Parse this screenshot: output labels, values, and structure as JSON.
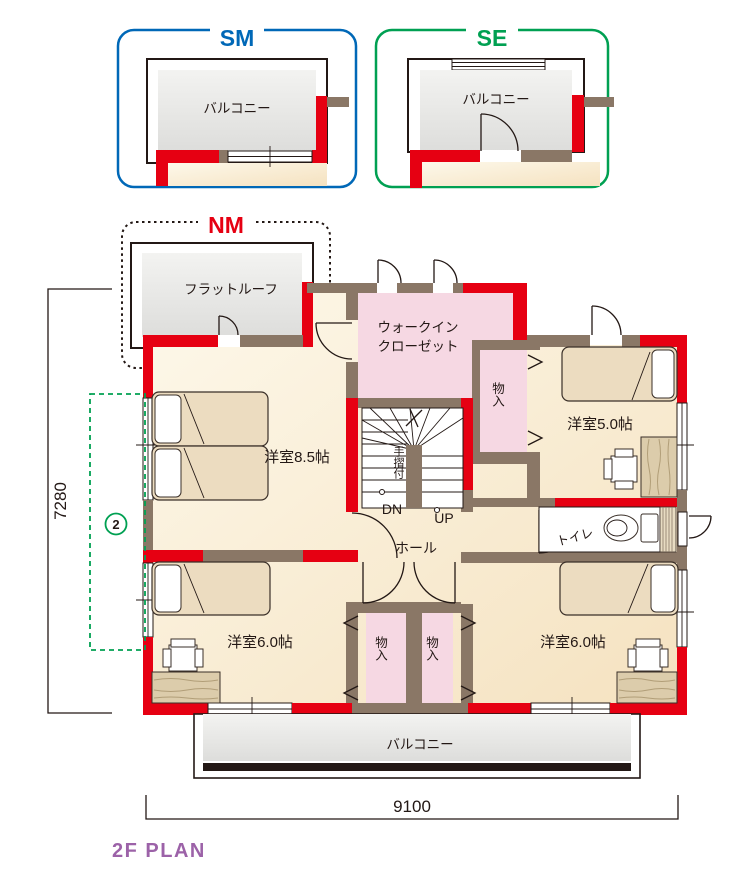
{
  "insets": {
    "sm": {
      "title": "SM",
      "label": "バルコニー"
    },
    "se": {
      "title": "SE",
      "label": "バルコニー"
    },
    "nm": {
      "title": "NM",
      "label": "フラットルーフ"
    }
  },
  "rooms": {
    "wic_line1": "ウォークイン",
    "wic_line2": "クローゼット",
    "closet_upper": "物入",
    "west85": "洋室8.5帖",
    "west50": "洋室5.0帖",
    "west60_left": "洋室6.0帖",
    "west60_right": "洋室6.0帖",
    "hall": "ホール",
    "toilet": "トイレ",
    "closet_left": "物入",
    "closet_right": "物入",
    "balcony": "バルコニー"
  },
  "stairs": {
    "handrail": "手摺付",
    "down": "DN",
    "up": "UP"
  },
  "dimensions": {
    "width": "9100",
    "height": "7280",
    "option_marker": "2"
  },
  "title": "2F PLAN",
  "colors": {
    "wall_red": "#e60012",
    "wall_brown": "#8a7766",
    "floor_cream": "#f9efd9",
    "closet_pink": "#f6d8e3",
    "balcony_gray": "#e7e7e4",
    "accent_blue": "#0068b7",
    "accent_green": "#00a052",
    "accent_red": "#e60012",
    "title_purple": "#9c62a8"
  }
}
